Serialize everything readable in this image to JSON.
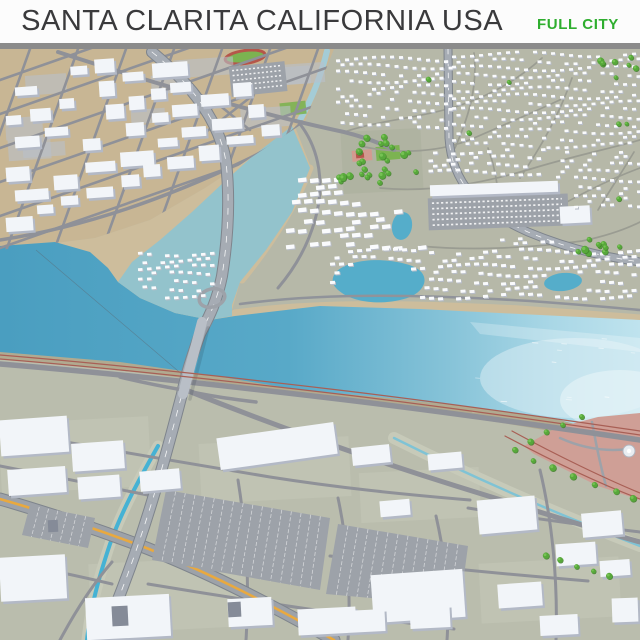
{
  "header": {
    "title": "SANTA CLARITA CALIFORNIA USA",
    "badge": "FULL CITY",
    "colors": {
      "header_bg": "#fcfcfc",
      "title_color": "#3a3a3c",
      "badge_color": "#2fae2f",
      "divider_color": "#8b8b8b"
    }
  },
  "map": {
    "alt": "3D aerial render of Santa Clarita city model: wide blue river crossed by a freeway bridge, industrial district upper left, hillside suburbs upper right, lagoon-side neighborhoods, commercial foreground with parking lots, parks, creeks and railway lines",
    "features": [
      "santa-clara-river",
      "freeway-bridge",
      "industrial-district",
      "suburban-neighborhoods",
      "central-park",
      "lagoon-community",
      "riverside-park",
      "railway-lines",
      "commercial-district",
      "parking-lots",
      "creek-channel",
      "running-track",
      "sports-field"
    ],
    "palette": {
      "ground_sage": "#b6b8a8",
      "ground_fore": "#babdad",
      "ground_tan": "#c8b694",
      "beach": "#cdbd9c",
      "beach_olive": "#b1aa90",
      "water": "#4a9ec0",
      "water_mid": "#58a9c8",
      "water_light": "#a9d7e6",
      "wash": "#8fc3cf",
      "shimmer": "#dff0f6",
      "lagoon": "#55adca",
      "creek": "#45b2d4",
      "creek_pale": "#a4ccd6",
      "channel_bank": "#c7cab9",
      "channel_water": "#7fc3d5",
      "road": "#8f9198",
      "road_thin": "#9a9c92",
      "road_major_fill": "#a6acb4",
      "road_casing": "#7e848c",
      "road_fore": "#9da2a9",
      "median_yellow": "#e9a93f",
      "rail": "#a85f55",
      "bridge_deck": "#b9bfc7",
      "bank_road": "#90939a",
      "building_top": "#f2f5f9",
      "building_side": "#b3b9c6",
      "building_dark": "#858b98",
      "parcel": "#b9c0ca",
      "parcel_fore": "#c5c9ba",
      "parking": "#9da2a9",
      "stripe": "#ffffff",
      "house_top": "#fafbfd",
      "house_side": "#b8bdc8",
      "tree": "#57a83a",
      "tree_dark": "#3f7f2a",
      "tree_light": "#79c457",
      "park_pink": "#cf9f96",
      "park_ground": "#aeb2a0",
      "court_pink": "#d39a90",
      "court_red": "#b5564a",
      "field_green": "#7cb351",
      "power_line": "#5a6b76"
    }
  }
}
